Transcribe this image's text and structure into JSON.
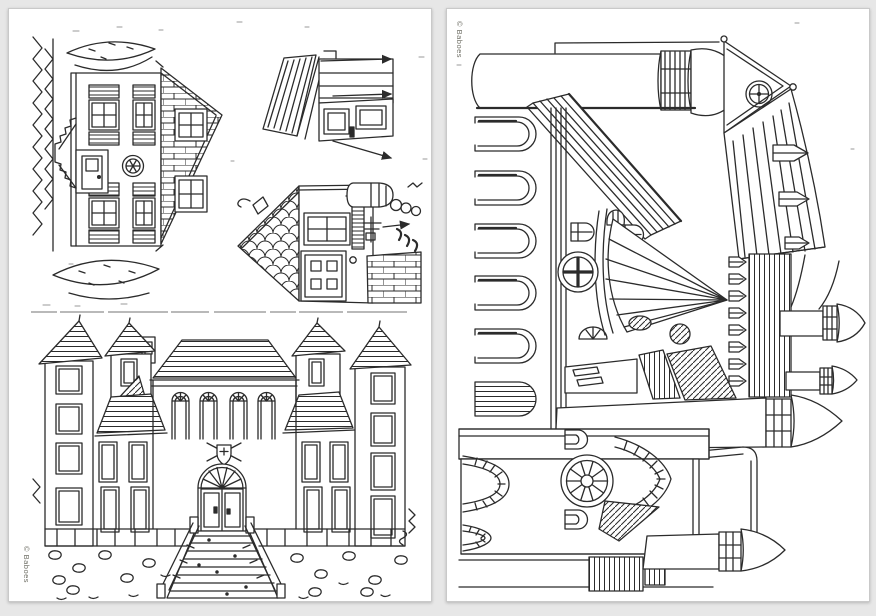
{
  "viewer": {
    "background_color": "#e7e7e7",
    "page_color": "#ffffff",
    "ink_color": "#2b2b2b"
  },
  "pages": [
    {
      "id": "left-coloring-page",
      "copyright": "© Baboes"
    },
    {
      "id": "right-coloring-page",
      "copyright": "© Baboes"
    }
  ]
}
